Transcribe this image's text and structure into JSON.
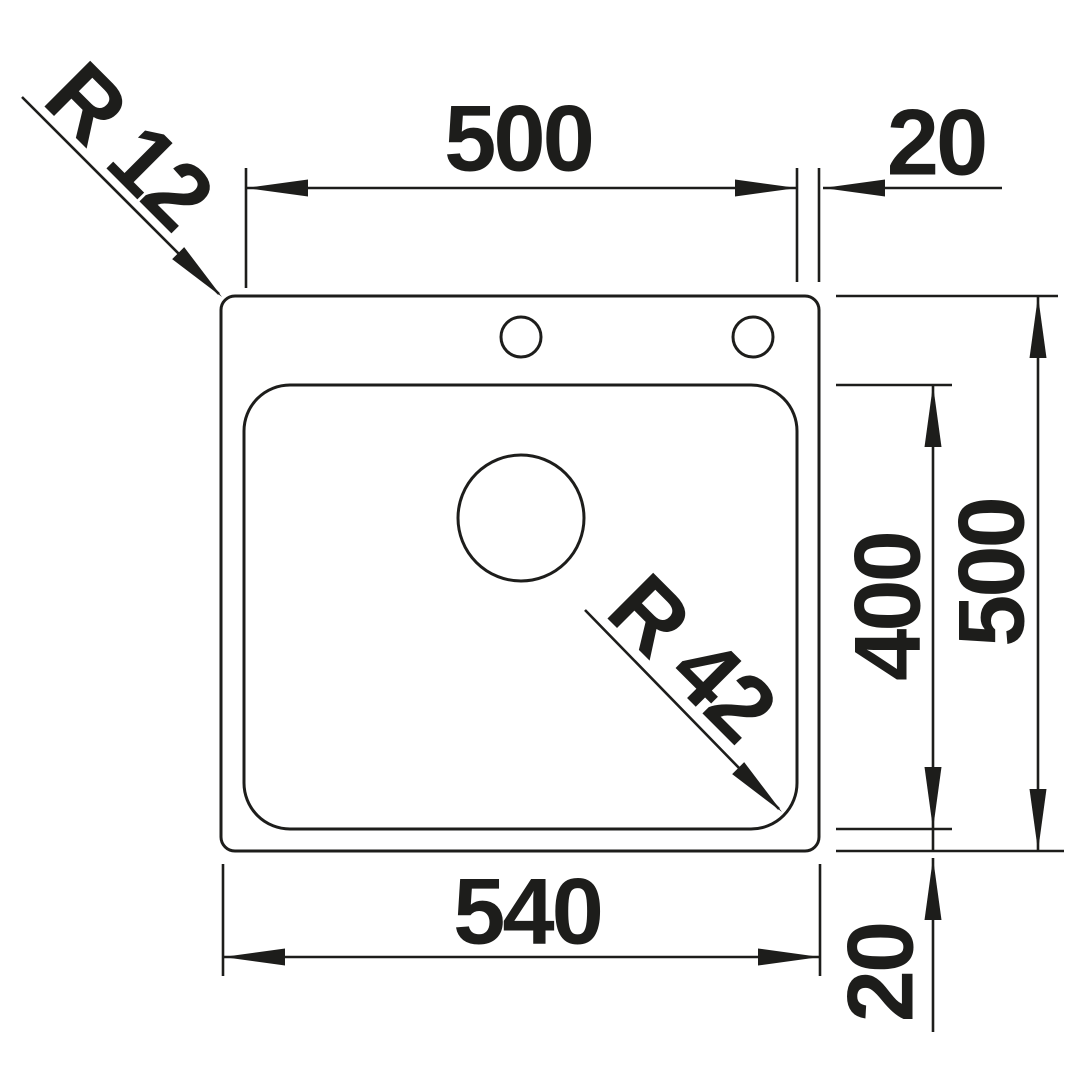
{
  "drawing": {
    "type": "technical-dimension-drawing",
    "subject": "kitchen sink top view with dimension lines",
    "ink_color": "#1d1d1b",
    "background_color": "#ffffff",
    "dimensions": {
      "bowl_width_top": {
        "label": "500",
        "value_mm": 500
      },
      "rim_offset_right": {
        "label": "20",
        "value_mm": 20
      },
      "bowl_depth_right": {
        "label": "400",
        "value_mm": 400
      },
      "overall_depth_right": {
        "label": "500",
        "value_mm": 500
      },
      "overall_width_bottom": {
        "label": "540",
        "value_mm": 540
      },
      "rim_offset_bottom": {
        "label": "20",
        "value_mm": 20
      },
      "outer_corner_radius": {
        "label": "R 12",
        "value_mm": 12
      },
      "bowl_corner_radius": {
        "label": "R 42",
        "value_mm": 42
      }
    },
    "features": {
      "faucet_holes": 2,
      "drain_holes": 1
    }
  }
}
